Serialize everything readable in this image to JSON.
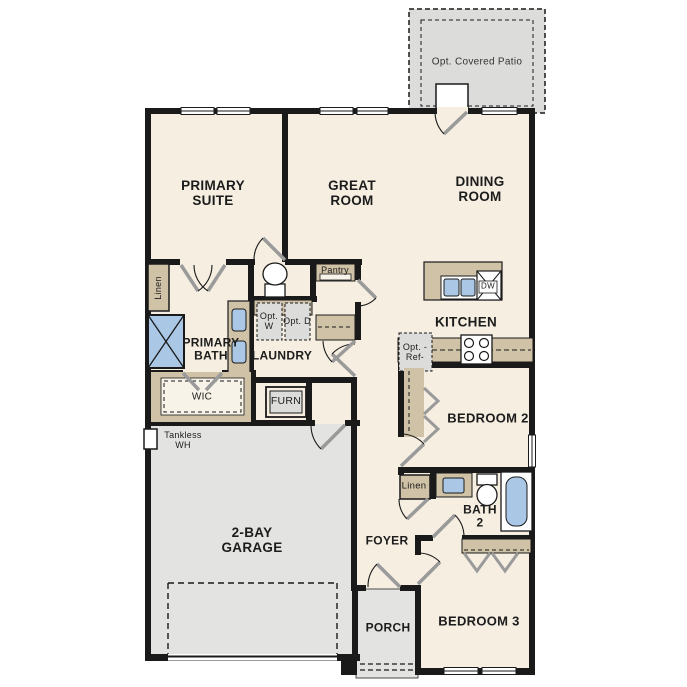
{
  "plan_title": "single-story home floor plan",
  "colors": {
    "wall": "#1a1a1a",
    "floor": "#f5eee1",
    "garage_floor": "#e3e3e1",
    "patio_floor": "#dcdcdb",
    "cabinet_tan": "#cfc2a6",
    "fixture_blue": "#aac8e6",
    "appliance_gray": "#dcdcda"
  },
  "labels": {
    "patio": "Opt. Covered Patio",
    "primary_suite": "PRIMARY SUITE",
    "great_room": "GREAT ROOM",
    "dining_room": "DINING ROOM",
    "kitchen": "KITCHEN",
    "pantry": "Pantry",
    "laundry": "LAUNDRY",
    "opt_washer": "Opt. W",
    "opt_dryer": "Opt. D",
    "primary_bath": "PRIMARY BATH",
    "linen_primary": "Linen",
    "wic": "WIC",
    "furnace": "FURN",
    "tankless_wh": "Tankless WH",
    "opt_ref": "Opt. -Ref-",
    "dishwasher": "DW",
    "bedroom_2": "BEDROOM 2",
    "linen_bath2": "Linen",
    "bath_2": "BATH 2",
    "garage": "2-BAY GARAGE",
    "foyer": "FOYER",
    "porch": "PORCH",
    "bedroom_3": "BEDROOM 3"
  },
  "fixtures": [
    "shower",
    "primary-toilet",
    "primary-double-vanity",
    "walk-in-closet-shelving",
    "kitchen-island",
    "island-double-sink",
    "dishwasher",
    "range-stove",
    "optional-refrigerator",
    "optional-washer",
    "optional-dryer",
    "pantry-shelf",
    "coat-closet-shelf",
    "furnace",
    "tankless-water-heater",
    "bath2-vanity-sink",
    "bath2-toilet",
    "bathtub",
    "bedroom2-closet",
    "bedroom3-closet-shelf",
    "porch-post",
    "garage-door-outline"
  ]
}
